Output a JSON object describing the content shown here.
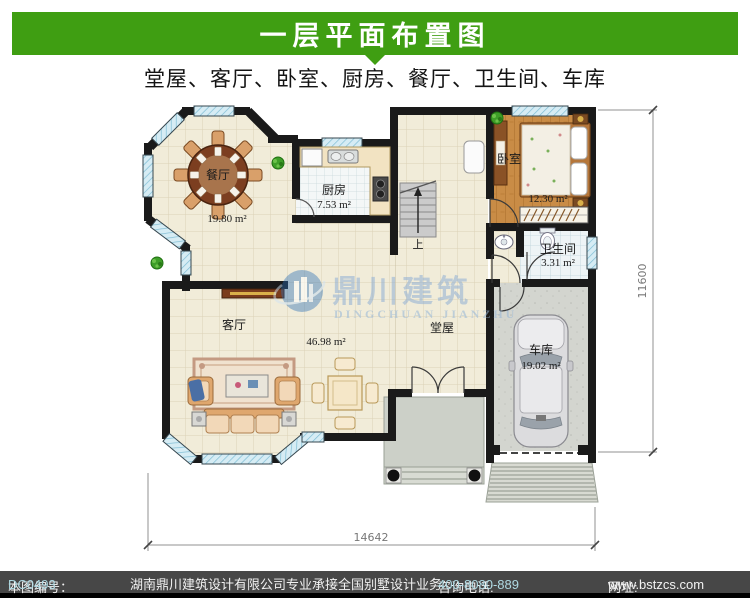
{
  "banner": {
    "title": "一层平面布置图"
  },
  "subtitle": "堂屋、客厅、卧室、厨房、餐厅、卫生间、车库",
  "rooms": {
    "dining": {
      "name": "餐厅",
      "area": "19.80 m²"
    },
    "kitchen": {
      "name": "厨房",
      "area": "7.53 m²"
    },
    "bedroom": {
      "name": "卧室",
      "area": "12.30 m²"
    },
    "bathroom": {
      "name": "卫生间",
      "area": "3.31 m²"
    },
    "living": {
      "name": "客厅",
      "area": "46.98 m²"
    },
    "hall": {
      "name": "堂屋"
    },
    "garage": {
      "name": "车库",
      "area": "19.02 m²"
    }
  },
  "stairs": {
    "up_label": "上"
  },
  "dimensions": {
    "width": "14642",
    "height": "11600"
  },
  "watermark": {
    "cn": "鼎川建筑",
    "en": "DINGCHUAN JIANZHU"
  },
  "footer": {
    "plan_no_label": "本图编号：",
    "plan_no": "DC0493",
    "company": "湖南鼎川建筑设计有限公司专业承接全国别墅设计业务",
    "phone_label": "咨询电话:",
    "phone": "400-8080-889",
    "site_label": "网址:",
    "site": "www.bstzcs.com"
  },
  "colors": {
    "banner_green": "#3f9e12",
    "footer_gray": "#474747"
  }
}
